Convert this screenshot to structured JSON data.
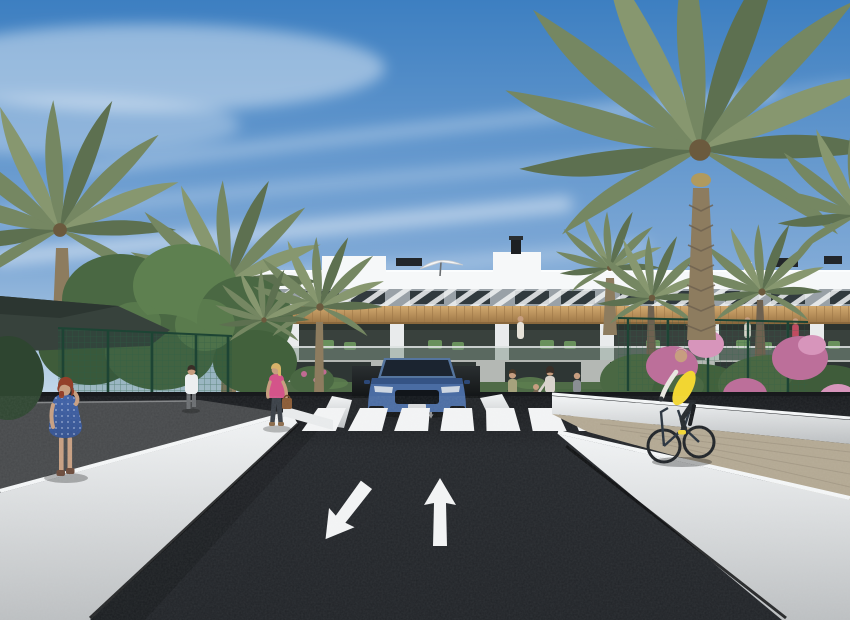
{
  "scene": {
    "type": "3d-architectural-rendering",
    "setting": "modern residential apartment complex with palm-lined entrance street",
    "objects": [
      "sky",
      "cirrus-clouds",
      "apartment-building",
      "rooftop-parasol",
      "rooftop-chimney",
      "palm-trees",
      "garden-trees",
      "shade-canopy",
      "sports-court-fence",
      "bougainvillea-bushes",
      "hedges",
      "entrance-plaza",
      "planter-boxes",
      "underground-garage-ramp",
      "suv-car",
      "bike-racks",
      "zebra-crosswalk",
      "lane-arrows",
      "asphalt-road",
      "pedestrian-walkway",
      "white-retaining-walls",
      "cycle-path",
      "cyclist",
      "pedestrians",
      "balcony-residents"
    ]
  },
  "markings": {
    "crosswalk_stripe_count": 8,
    "lane_arrow_count": 2,
    "lane_arrows": [
      "straight-ahead",
      "toward-viewer"
    ]
  },
  "figures": {
    "pedestrians_foreground": 3,
    "pedestrians_near_building": 4,
    "cyclists": 1,
    "balcony_figures": 3
  },
  "vehicles": {
    "cars": 1,
    "car_color": "steel-blue",
    "bicycles_visible": 2
  },
  "palette": {
    "sky-top": "#3d7fc1",
    "sky-mid": "#7fa9d6",
    "sky-horizon": "#cfe0ec",
    "building-white": "#eff1f2",
    "parapet": "#f6f8f9",
    "slat-band": "#99a1a7",
    "window-dark": "#313a3e",
    "wood": "#c59b63",
    "wood-dark": "#9a7444",
    "balcony-shadow": "#39413d",
    "glass-green": "#7c9184",
    "hedge": "#4f6b47",
    "ground-band": "#b4b8b4",
    "palm-green": "#758762",
    "palm-dark": "#5d7050",
    "palm-light": "#87976f",
    "trunk": "#8d7c5f",
    "tree-green": "#4a6843",
    "tree-light": "#5e8050",
    "canopy": "#37423c",
    "fence-green": "#2c5b45",
    "flower-pink": "#bc6f9a",
    "flower-light": "#d795bb",
    "asphalt": "#24272b",
    "asphalt-dark": "#17191c",
    "walk-gray": "#46484a",
    "wall-lit": "#e9ebec",
    "wall-shadow": "#bcbfc1",
    "curb-white": "#f4f6f7",
    "path-beige": "#b3a892",
    "plaza": "#b2aca0",
    "car-blue": "#4a6ca3",
    "car-dark": "#2c4877",
    "glass-dark": "#1b2430",
    "vest-yellow": "#f2d632",
    "dress-blue": "#3e61a8",
    "top-pink": "#d4548a",
    "skin": "#c79e80",
    "hair-red": "#93402a",
    "hair-blonde": "#d8b369",
    "marking-white": "#f3f4f5"
  }
}
